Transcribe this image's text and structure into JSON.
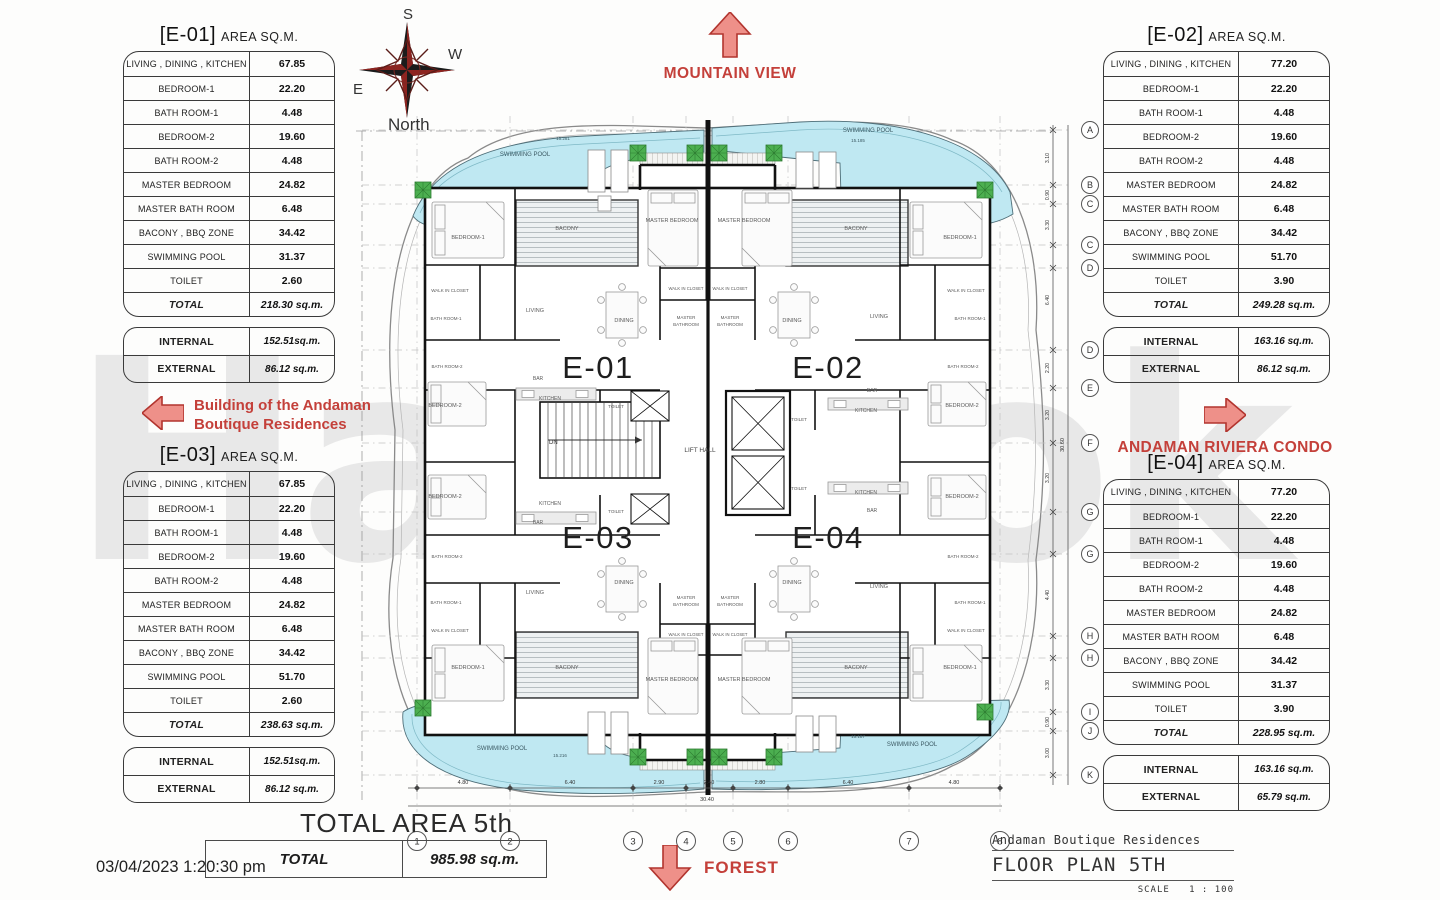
{
  "watermark": "Hawook",
  "compass": {
    "top": "S",
    "right": "W",
    "left": "E",
    "bottom": "North"
  },
  "annotations": {
    "mountain": "MOUNTAIN VIEW",
    "forest": "FOREST",
    "building_line1": "Building of the Andaman",
    "building_line2": "Boutique Residences",
    "condo": "ANDAMAN RIVIERA CONDO"
  },
  "footer": {
    "total_area_title": "TOTAL AREA 5th",
    "total_label": "TOTAL",
    "total_value": "985.98 sq.m.",
    "timestamp": "03/04/2023 1:20:30 pm"
  },
  "title_block": {
    "project": "Andaman Boutique Residences",
    "drawing": "FLOOR PLAN 5TH",
    "scale_label": "SCALE",
    "scale_value": "1 : 100"
  },
  "units": [
    {
      "id": "E-01",
      "title_bracket": "[E-01]",
      "title_rest": "AREA SQ.M.",
      "rows": [
        [
          "LIVING , DINING , KITCHEN",
          "67.85"
        ],
        [
          "BEDROOM-1",
          "22.20"
        ],
        [
          "BATH ROOM-1",
          "4.48"
        ],
        [
          "BEDROOM-2",
          "19.60"
        ],
        [
          "BATH ROOM-2",
          "4.48"
        ],
        [
          "MASTER BEDROOM",
          "24.82"
        ],
        [
          "MASTER BATH ROOM",
          "6.48"
        ],
        [
          "BACONY , BBQ  ZONE",
          "34.42"
        ],
        [
          "SWIMMING POOL",
          "31.37"
        ],
        [
          "TOILET",
          "2.60"
        ]
      ],
      "total_label": "TOTAL",
      "total_value": "218.30 sq.m.",
      "internal_label": "INTERNAL",
      "internal_value": "152.51sq.m.",
      "external_label": "EXTERNAL",
      "external_value": "86.12 sq.m."
    },
    {
      "id": "E-02",
      "title_bracket": "[E-02]",
      "title_rest": "AREA SQ.M.",
      "rows": [
        [
          "LIVING , DINING , KITCHEN",
          "77.20"
        ],
        [
          "BEDROOM-1",
          "22.20"
        ],
        [
          "BATH ROOM-1",
          "4.48"
        ],
        [
          "BEDROOM-2",
          "19.60"
        ],
        [
          "BATH ROOM-2",
          "4.48"
        ],
        [
          "MASTER BEDROOM",
          "24.82"
        ],
        [
          "MASTER BATH ROOM",
          "6.48"
        ],
        [
          "BACONY , BBQ  ZONE",
          "34.42"
        ],
        [
          "SWIMMING POOL",
          "51.70"
        ],
        [
          "TOILET",
          "3.90"
        ]
      ],
      "total_label": "TOTAL",
      "total_value": "249.28 sq.m.",
      "internal_label": "INTERNAL",
      "internal_value": "163.16 sq.m.",
      "external_label": "EXTERNAL",
      "external_value": "86.12 sq.m."
    },
    {
      "id": "E-03",
      "title_bracket": "[E-03]",
      "title_rest": "AREA SQ.M.",
      "rows": [
        [
          "LIVING , DINING , KITCHEN",
          "67.85"
        ],
        [
          "BEDROOM-1",
          "22.20"
        ],
        [
          "BATH ROOM-1",
          "4.48"
        ],
        [
          "BEDROOM-2",
          "19.60"
        ],
        [
          "BATH ROOM-2",
          "4.48"
        ],
        [
          "MASTER BEDROOM",
          "24.82"
        ],
        [
          "MASTER BATH ROOM",
          "6.48"
        ],
        [
          "BACONY , BBQ  ZONE",
          "34.42"
        ],
        [
          "SWIMMING POOL",
          "51.70"
        ],
        [
          "TOILET",
          "2.60"
        ]
      ],
      "total_label": "TOTAL",
      "total_value": "238.63 sq.m.",
      "internal_label": "INTERNAL",
      "internal_value": "152.51sq.m.",
      "external_label": "EXTERNAL",
      "external_value": "86.12 sq.m."
    },
    {
      "id": "E-04",
      "title_bracket": "[E-04]",
      "title_rest": "AREA SQ.M.",
      "rows": [
        [
          "LIVING , DINING , KITCHEN",
          "77.20"
        ],
        [
          "BEDROOM-1",
          "22.20"
        ],
        [
          "BATH ROOM-1",
          "4.48"
        ],
        [
          "BEDROOM-2",
          "19.60"
        ],
        [
          "BATH ROOM-2",
          "4.48"
        ],
        [
          "MASTER BEDROOM",
          "24.82"
        ],
        [
          "MASTER BATH ROOM",
          "6.48"
        ],
        [
          "BACONY , BBQ  ZONE",
          "34.42"
        ],
        [
          "SWIMMING POOL",
          "31.37"
        ],
        [
          "TOILET",
          "3.90"
        ]
      ],
      "total_label": "TOTAL",
      "total_value": "228.95 sq.m.",
      "internal_label": "INTERNAL",
      "internal_value": "163.16 sq.m.",
      "external_label": "EXTERNAL",
      "external_value": "65.79 sq.m."
    }
  ],
  "plan": {
    "unit_marks": [
      {
        "t": "E-01",
        "x": 598,
        "y": 378
      },
      {
        "t": "E-02",
        "x": 828,
        "y": 378
      },
      {
        "t": "E-03",
        "x": 598,
        "y": 548
      },
      {
        "t": "E-04",
        "x": 828,
        "y": 548
      }
    ],
    "lift_hall": {
      "t": "LIFT HALL",
      "x": 700,
      "y": 452
    },
    "room_labels": [
      {
        "t": "BEDROOM-1",
        "x": 468,
        "y": 239
      },
      {
        "t": "BACONY",
        "x": 567,
        "y": 230
      },
      {
        "t": "MASTER BEDROOM",
        "x": 672,
        "y": 222
      },
      {
        "t": "MASTER BEDROOM",
        "x": 744,
        "y": 222
      },
      {
        "t": "BACONY",
        "x": 856,
        "y": 230
      },
      {
        "t": "BEDROOM-1",
        "x": 960,
        "y": 239
      },
      {
        "t": "WALK IN CLOSET",
        "x": 450,
        "y": 292,
        "s": 4.5
      },
      {
        "t": "BATH ROOM-1",
        "x": 446,
        "y": 320,
        "s": 4.5
      },
      {
        "t": "WALK IN CLOSET",
        "x": 686,
        "y": 290,
        "s": 4.2
      },
      {
        "t": "WALK IN CLOSET",
        "x": 730,
        "y": 290,
        "s": 4.2
      },
      {
        "t": "MASTER",
        "x": 686,
        "y": 319,
        "s": 4.5
      },
      {
        "t": "BATHROOM",
        "x": 686,
        "y": 326,
        "s": 4.5
      },
      {
        "t": "MASTER",
        "x": 730,
        "y": 319,
        "s": 4.5
      },
      {
        "t": "BATHROOM",
        "x": 730,
        "y": 326,
        "s": 4.5
      },
      {
        "t": "WALK IN CLOSET",
        "x": 966,
        "y": 292,
        "s": 4.5
      },
      {
        "t": "BATH ROOM-1",
        "x": 970,
        "y": 320,
        "s": 4.5
      },
      {
        "t": "LIVING",
        "x": 535,
        "y": 312
      },
      {
        "t": "DINING",
        "x": 624,
        "y": 322
      },
      {
        "t": "DINING",
        "x": 792,
        "y": 322
      },
      {
        "t": "LIVING",
        "x": 879,
        "y": 318
      },
      {
        "t": "BEDROOM-2",
        "x": 445,
        "y": 407
      },
      {
        "t": "BAR",
        "x": 538,
        "y": 380,
        "s": 5
      },
      {
        "t": "KITCHEN",
        "x": 550,
        "y": 400,
        "s": 5
      },
      {
        "t": "TOILET",
        "x": 616,
        "y": 408,
        "s": 4.5
      },
      {
        "t": "TOILET",
        "x": 799,
        "y": 421,
        "s": 4.5
      },
      {
        "t": "BAR",
        "x": 872,
        "y": 392,
        "s": 5
      },
      {
        "t": "KITCHEN",
        "x": 866,
        "y": 412,
        "s": 5
      },
      {
        "t": "BEDROOM-2",
        "x": 962,
        "y": 407
      },
      {
        "t": "BATH ROOM-2",
        "x": 447,
        "y": 368,
        "s": 4.5
      },
      {
        "t": "BATH ROOM-2",
        "x": 963,
        "y": 368,
        "s": 4.5
      },
      {
        "t": "BEDROOM-2",
        "x": 445,
        "y": 498
      },
      {
        "t": "KITCHEN",
        "x": 550,
        "y": 505,
        "s": 5
      },
      {
        "t": "BAR",
        "x": 538,
        "y": 524,
        "s": 5
      },
      {
        "t": "TOILET",
        "x": 616,
        "y": 513,
        "s": 4.5
      },
      {
        "t": "TOILET",
        "x": 799,
        "y": 490,
        "s": 4.5
      },
      {
        "t": "KITCHEN",
        "x": 866,
        "y": 494,
        "s": 5
      },
      {
        "t": "BAR",
        "x": 872,
        "y": 512,
        "s": 5
      },
      {
        "t": "BEDROOM-2",
        "x": 962,
        "y": 498
      },
      {
        "t": "BATH ROOM-2",
        "x": 447,
        "y": 558,
        "s": 4.5
      },
      {
        "t": "BATH ROOM-2",
        "x": 963,
        "y": 558,
        "s": 4.5
      },
      {
        "t": "LIVING",
        "x": 535,
        "y": 594
      },
      {
        "t": "DINING",
        "x": 624,
        "y": 584
      },
      {
        "t": "DINING",
        "x": 792,
        "y": 584
      },
      {
        "t": "LIVING",
        "x": 879,
        "y": 588
      },
      {
        "t": "BATH ROOM-1",
        "x": 446,
        "y": 604,
        "s": 4.5
      },
      {
        "t": "WALK IN CLOSET",
        "x": 450,
        "y": 632,
        "s": 4.5
      },
      {
        "t": "MASTER",
        "x": 686,
        "y": 599,
        "s": 4.5
      },
      {
        "t": "BATHROOM",
        "x": 686,
        "y": 606,
        "s": 4.5
      },
      {
        "t": "MASTER",
        "x": 730,
        "y": 599,
        "s": 4.5
      },
      {
        "t": "BATHROOM",
        "x": 730,
        "y": 606,
        "s": 4.5
      },
      {
        "t": "WALK IN CLOSET",
        "x": 686,
        "y": 636,
        "s": 4.2
      },
      {
        "t": "WALK IN CLOSET",
        "x": 730,
        "y": 636,
        "s": 4.2
      },
      {
        "t": "BATH ROOM-1",
        "x": 970,
        "y": 604,
        "s": 4.5
      },
      {
        "t": "WALK IN CLOSET",
        "x": 966,
        "y": 632,
        "s": 4.5
      },
      {
        "t": "BEDROOM-1",
        "x": 468,
        "y": 669
      },
      {
        "t": "BACONY",
        "x": 567,
        "y": 669
      },
      {
        "t": "MASTER BEDROOM",
        "x": 672,
        "y": 681
      },
      {
        "t": "MASTER BEDROOM",
        "x": 744,
        "y": 681
      },
      {
        "t": "BACONY",
        "x": 856,
        "y": 669
      },
      {
        "t": "BEDROOM-1",
        "x": 960,
        "y": 669
      }
    ],
    "pool_labels": [
      {
        "t": "SWIMMING POOL",
        "x": 525,
        "y": 156,
        "s": 6
      },
      {
        "t": "15.281",
        "x": 563,
        "y": 140,
        "s": 4.5
      },
      {
        "t": "SWIMMING POOL",
        "x": 868,
        "y": 132,
        "s": 6
      },
      {
        "t": "15.185",
        "x": 858,
        "y": 142,
        "s": 4.5
      },
      {
        "t": "SWIMMING POOL",
        "x": 502,
        "y": 750,
        "s": 6
      },
      {
        "t": "15.216",
        "x": 560,
        "y": 757,
        "s": 4.5
      },
      {
        "t": "SWIMMING POOL",
        "x": 912,
        "y": 746,
        "s": 6
      },
      {
        "t": "15.187",
        "x": 858,
        "y": 738,
        "s": 4.5
      }
    ],
    "grid_cols": [
      {
        "n": "1",
        "x": 417
      },
      {
        "n": "2",
        "x": 510
      },
      {
        "n": "3",
        "x": 633
      },
      {
        "n": "4",
        "x": 686
      },
      {
        "n": "5",
        "x": 733
      },
      {
        "n": "6",
        "x": 788
      },
      {
        "n": "7",
        "x": 909
      },
      {
        "n": "8",
        "x": 1000
      }
    ],
    "grid_rows": [
      {
        "n": "A",
        "y": 130
      },
      {
        "n": "B",
        "y": 185
      },
      {
        "n": "C",
        "y": 204
      },
      {
        "n": "C",
        "y": 245
      },
      {
        "n": "D",
        "y": 268
      },
      {
        "n": "D",
        "y": 350
      },
      {
        "n": "E",
        "y": 388
      },
      {
        "n": "F",
        "y": 443
      },
      {
        "n": "G",
        "y": 512
      },
      {
        "n": "G",
        "y": 554
      },
      {
        "n": "H",
        "y": 636
      },
      {
        "n": "H",
        "y": 658
      },
      {
        "n": "I",
        "y": 712
      },
      {
        "n": "J",
        "y": 731
      },
      {
        "n": "K",
        "y": 775
      }
    ],
    "dims_bottom": [
      {
        "t": "4.80",
        "x": 463
      },
      {
        "t": "6.40",
        "x": 570
      },
      {
        "t": "2.90",
        "x": 659
      },
      {
        "t": "2.40",
        "x": 709
      },
      {
        "t": "2.80",
        "x": 760
      },
      {
        "t": "6.40",
        "x": 848
      },
      {
        "t": "4.80",
        "x": 954
      }
    ],
    "dims_bottom_total": {
      "t": "30.40",
      "x": 707,
      "y": 801
    },
    "dims_right": [
      {
        "t": "3.10",
        "y": 158
      },
      {
        "t": "0.90",
        "y": 195
      },
      {
        "t": "3.30",
        "y": 225
      },
      {
        "t": "6.40",
        "y": 300
      },
      {
        "t": "2.20",
        "y": 368
      },
      {
        "t": "3.20",
        "y": 415
      },
      {
        "t": "3.20",
        "y": 478
      },
      {
        "t": "4.40",
        "y": 595
      },
      {
        "t": "3.30",
        "y": 685
      },
      {
        "t": "0.90",
        "y": 722
      },
      {
        "t": "3.00",
        "y": 753
      }
    ],
    "dims_right_total": {
      "t": "30.60",
      "y": 445
    },
    "stairs_label": "DN",
    "plants": [
      {
        "x": 423,
        "y": 190
      },
      {
        "x": 638,
        "y": 153
      },
      {
        "x": 695,
        "y": 153
      },
      {
        "x": 719,
        "y": 153
      },
      {
        "x": 774,
        "y": 153
      },
      {
        "x": 985,
        "y": 190
      },
      {
        "x": 423,
        "y": 708
      },
      {
        "x": 638,
        "y": 757
      },
      {
        "x": 695,
        "y": 757
      },
      {
        "x": 719,
        "y": 757
      },
      {
        "x": 774,
        "y": 757
      },
      {
        "x": 985,
        "y": 712
      }
    ],
    "loungers": [
      {
        "x": 588,
        "y": 150,
        "w": 17,
        "h": 42
      },
      {
        "x": 611,
        "y": 150,
        "w": 17,
        "h": 42
      },
      {
        "x": 598,
        "y": 196,
        "w": 13,
        "h": 15
      },
      {
        "x": 796,
        "y": 152,
        "w": 17,
        "h": 36
      },
      {
        "x": 819,
        "y": 152,
        "w": 17,
        "h": 36
      },
      {
        "x": 588,
        "y": 712,
        "w": 17,
        "h": 42
      },
      {
        "x": 611,
        "y": 712,
        "w": 17,
        "h": 42
      },
      {
        "x": 796,
        "y": 716,
        "w": 17,
        "h": 36
      },
      {
        "x": 819,
        "y": 716,
        "w": 17,
        "h": 36
      }
    ],
    "beds": [
      {
        "x": 432,
        "y": 202,
        "w": 72,
        "h": 56
      },
      {
        "x": 910,
        "y": 202,
        "w": 72,
        "h": 56
      },
      {
        "x": 432,
        "y": 645,
        "w": 72,
        "h": 56
      },
      {
        "x": 910,
        "y": 645,
        "w": 72,
        "h": 56
      },
      {
        "x": 648,
        "y": 190,
        "w": 50,
        "h": 76
      },
      {
        "x": 742,
        "y": 190,
        "w": 50,
        "h": 76
      },
      {
        "x": 648,
        "y": 638,
        "w": 50,
        "h": 76
      },
      {
        "x": 742,
        "y": 638,
        "w": 50,
        "h": 76
      },
      {
        "x": 428,
        "y": 382,
        "w": 58,
        "h": 44
      },
      {
        "x": 428,
        "y": 475,
        "w": 58,
        "h": 44
      },
      {
        "x": 928,
        "y": 382,
        "w": 58,
        "h": 44
      },
      {
        "x": 928,
        "y": 475,
        "w": 58,
        "h": 44
      }
    ],
    "tables": [
      {
        "x": 606,
        "y": 292,
        "w": 32,
        "h": 46
      },
      {
        "x": 778,
        "y": 292,
        "w": 32,
        "h": 46
      },
      {
        "x": 606,
        "y": 566,
        "w": 32,
        "h": 46
      },
      {
        "x": 778,
        "y": 566,
        "w": 32,
        "h": 46
      }
    ],
    "counters": [
      {
        "x": 516,
        "y": 388,
        "w": 80,
        "h": 12
      },
      {
        "x": 516,
        "y": 512,
        "w": 80,
        "h": 12
      },
      {
        "x": 828,
        "y": 398,
        "w": 80,
        "h": 12
      },
      {
        "x": 828,
        "y": 482,
        "w": 80,
        "h": 12
      }
    ]
  }
}
